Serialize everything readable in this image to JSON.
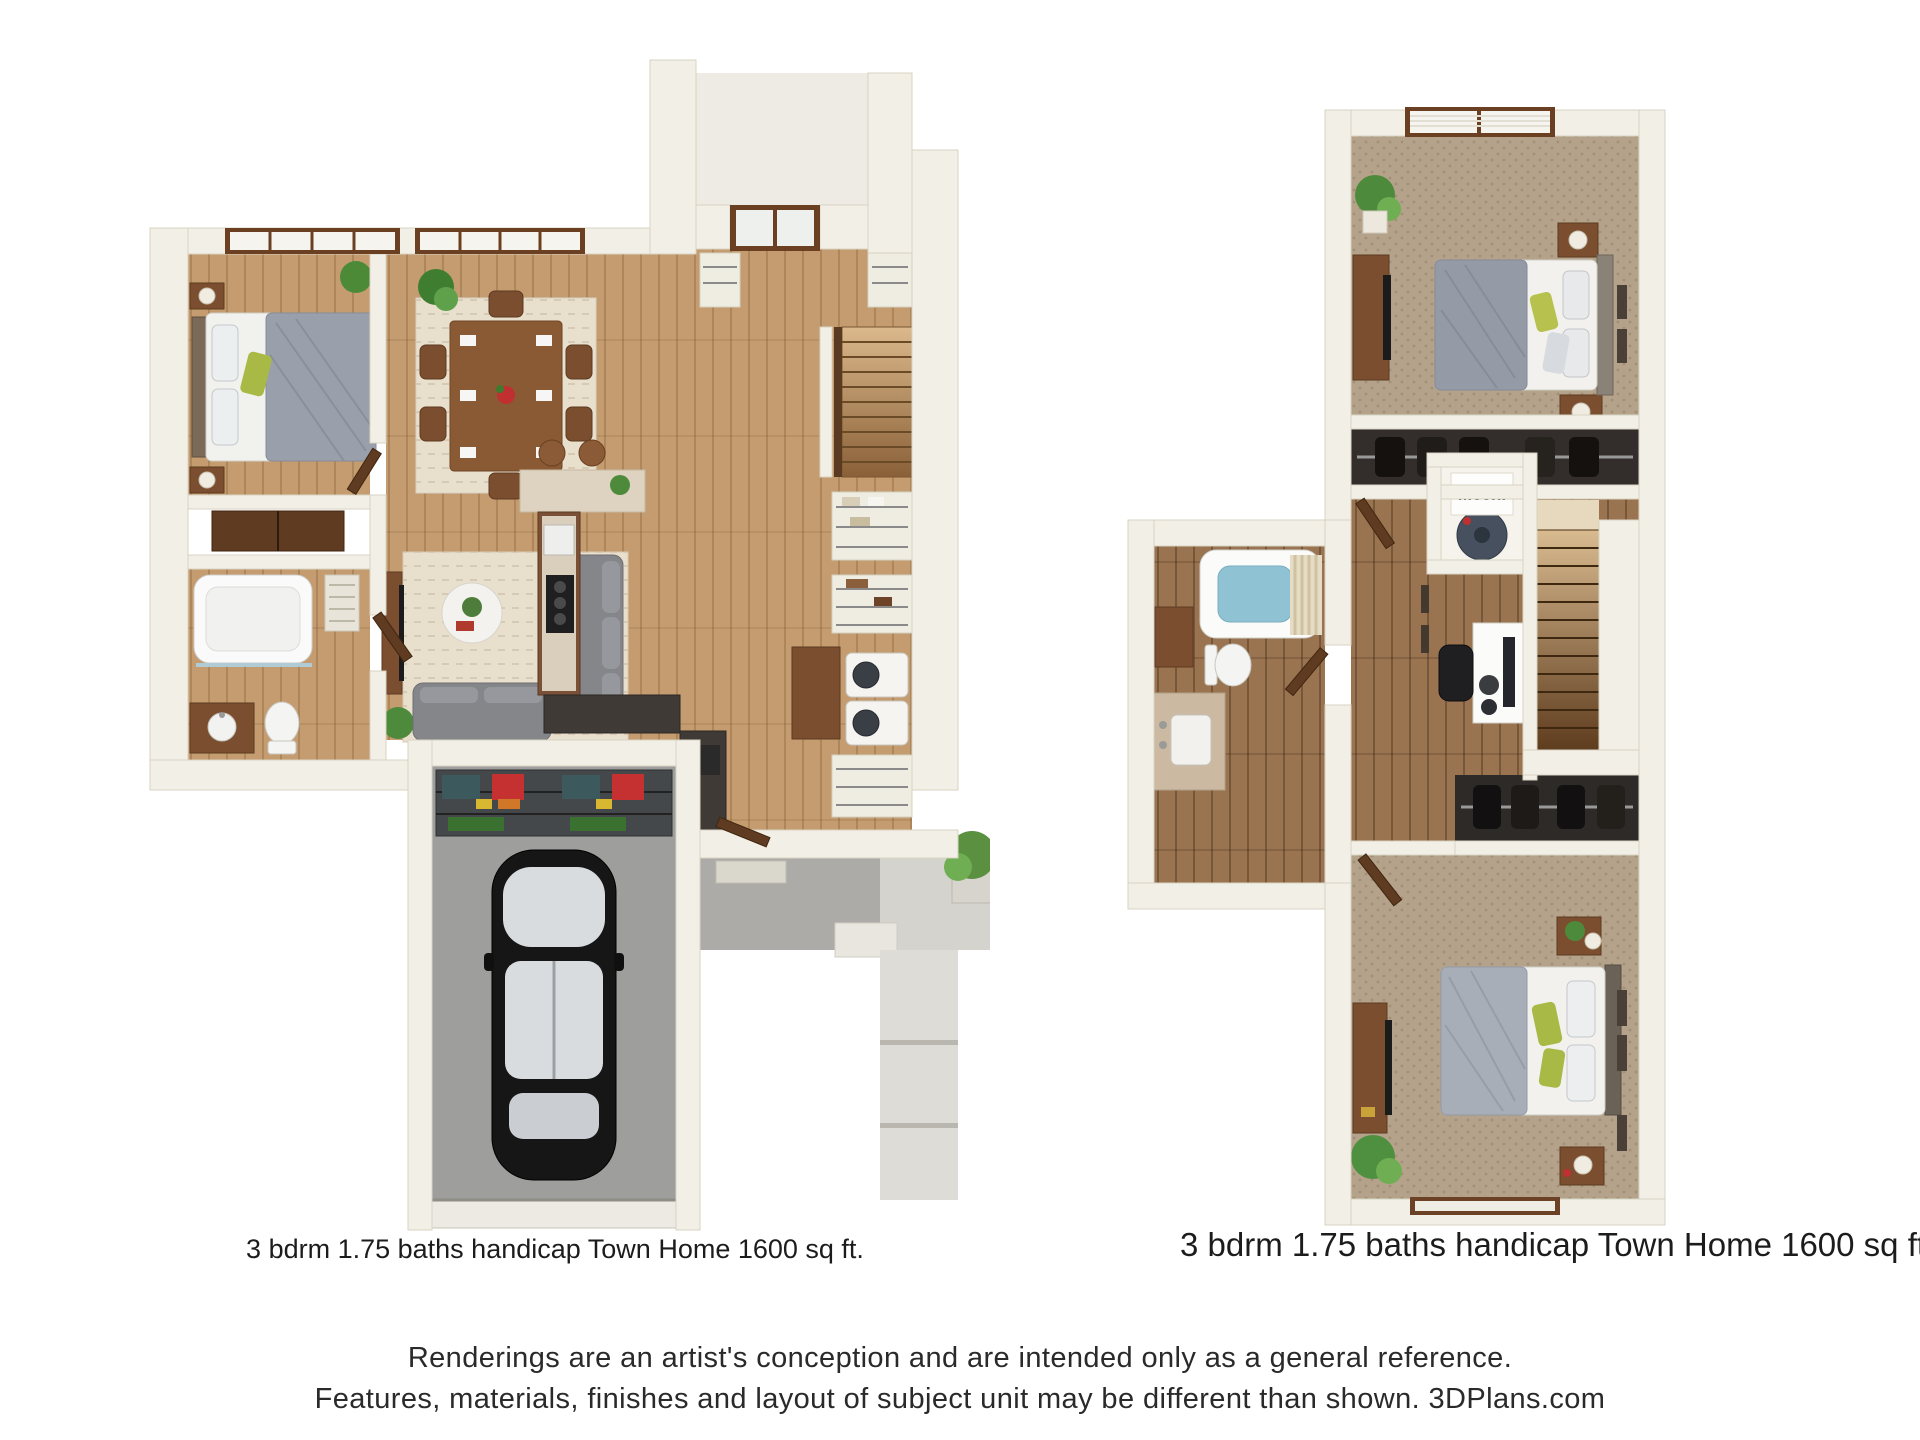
{
  "page": {
    "background": "#ffffff"
  },
  "plans": {
    "first_floor": {
      "caption": "3 bdrm 1.75 baths handicap Town Home 1600 sq ft."
    },
    "second_floor": {
      "caption": "3 bdrm 1.75 baths handicap Town Home 1600 sq ft.",
      "mech_label": "Mech."
    }
  },
  "disclaimer": {
    "line1": "Renderings are an artist's conception and are intended only as a general reference.",
    "line2": "Features, materials, finishes and layout of subject unit may be different than shown. 3DPlans.com"
  },
  "colors": {
    "wall": "#f2efe6",
    "wall_shade": "#e3dfd0",
    "wood_floor": "#c49c70",
    "wood_floor_dark": "#9a7450",
    "carpet": "#b4a38a",
    "concrete": "#9e9e9c",
    "rug": "#e9dfcd",
    "accent_green": "#a9b946",
    "water_blue": "#8fc3d4",
    "car_body": "#161616"
  }
}
